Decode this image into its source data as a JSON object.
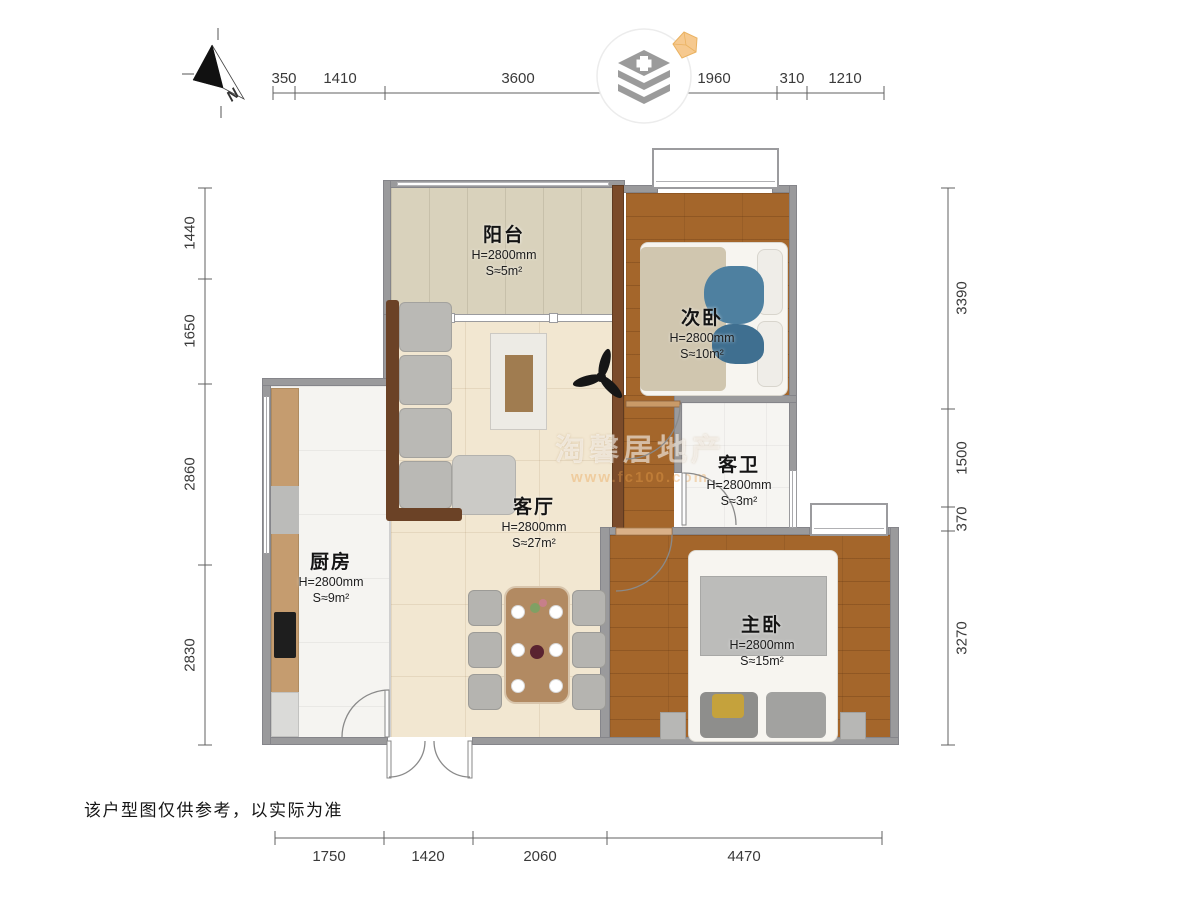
{
  "disclaimer": "该户型图仅供参考，以实际为准",
  "compass": {
    "label": "N"
  },
  "watermark": {
    "brand": "淘馨居地产",
    "url": "www.fc100.com"
  },
  "rooms": [
    {
      "name": "阳台",
      "height": "H=2800mm",
      "area": "S≈5m²"
    },
    {
      "name": "次卧",
      "height": "H=2800mm",
      "area": "S≈10m²"
    },
    {
      "name": "客厅",
      "height": "H=2800mm",
      "area": "S≈27m²"
    },
    {
      "name": "客卫",
      "height": "H=2800mm",
      "area": "S≈3m²"
    },
    {
      "name": "厨房",
      "height": "H=2800mm",
      "area": "S≈9m²"
    },
    {
      "name": "主卧",
      "height": "H=2800mm",
      "area": "S≈15m²"
    }
  ],
  "dimensions": {
    "top": [
      "350",
      "1410",
      "3600",
      "1960",
      "310",
      "1210"
    ],
    "left": [
      "1440",
      "1650",
      "2860",
      "2830"
    ],
    "right": [
      "3390",
      "1500",
      "370",
      "3270"
    ],
    "bottom": [
      "1750",
      "1420",
      "2060",
      "4470"
    ]
  },
  "colors": {
    "wall": "#9a9a9c",
    "wood_floor": "#a4662b",
    "living_floor": "#f2e7d1",
    "balcony_floor": "#d9d2bc",
    "diamond_badge": "#f6c98f"
  }
}
